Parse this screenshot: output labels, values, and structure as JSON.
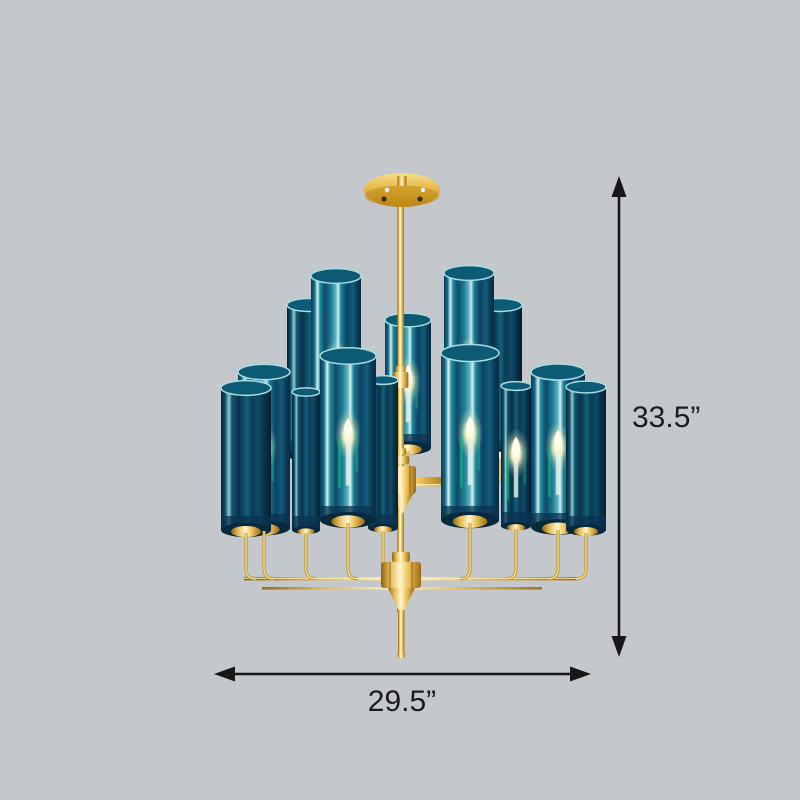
{
  "scene": {
    "description": "Product dimension photo of a two-tier brass chandelier with cylindrical teal glass shades and candle bulbs, on a plain gray background",
    "background_color": "#c4c7cc"
  },
  "annotations": {
    "height_label": "33.5”",
    "width_label": "29.5”",
    "line_color": "#17171a",
    "text_color": "#1c1c1e",
    "font_size_px": 30
  },
  "chandelier": {
    "metal_color": "#d9a93c",
    "metal_highlight": "#ffeeb0",
    "metal_shadow": "#8f6212",
    "glass_teal": "#17788e",
    "glass_dark_navy": "#0b3350",
    "glass_highlight": "#d5f1f1",
    "bulb_glow_color": "#fdf3c0",
    "green_reflection": "#1fc08d",
    "upper_cylinders": [
      {
        "x": 309,
        "top": 305,
        "w": 44,
        "h": 150,
        "variant": "dark",
        "lit": false
      },
      {
        "x": 500,
        "top": 305,
        "w": 44,
        "h": 150,
        "variant": "dark",
        "lit": false
      },
      {
        "x": 336,
        "top": 276,
        "w": 50,
        "h": 185,
        "variant": "bright",
        "lit": true
      },
      {
        "x": 469,
        "top": 273,
        "w": 50,
        "h": 185,
        "variant": "bright",
        "lit": true
      },
      {
        "x": 408,
        "top": 320,
        "w": 46,
        "h": 128,
        "variant": "bright",
        "lit": true
      }
    ],
    "lower_cylinders": [
      {
        "x": 306,
        "top": 392,
        "w": 28,
        "h": 138,
        "variant": "dark",
        "lit": false
      },
      {
        "x": 516,
        "top": 386,
        "w": 30,
        "h": 140,
        "variant": "dark",
        "lit": true
      },
      {
        "x": 264,
        "top": 372,
        "w": 52,
        "h": 156,
        "variant": "bright",
        "lit": true
      },
      {
        "x": 558,
        "top": 372,
        "w": 54,
        "h": 155,
        "variant": "bright",
        "lit": true
      },
      {
        "x": 383,
        "top": 380,
        "w": 30,
        "h": 148,
        "variant": "dark",
        "lit": false
      },
      {
        "x": 246,
        "top": 388,
        "w": 50,
        "h": 142,
        "variant": "dark",
        "lit": false
      },
      {
        "x": 586,
        "top": 387,
        "w": 40,
        "h": 143,
        "variant": "dark",
        "lit": false
      },
      {
        "x": 348,
        "top": 356,
        "w": 56,
        "h": 164,
        "variant": "bright",
        "lit": true
      },
      {
        "x": 470,
        "top": 353,
        "w": 58,
        "h": 167,
        "variant": "bright",
        "lit": true
      }
    ]
  }
}
